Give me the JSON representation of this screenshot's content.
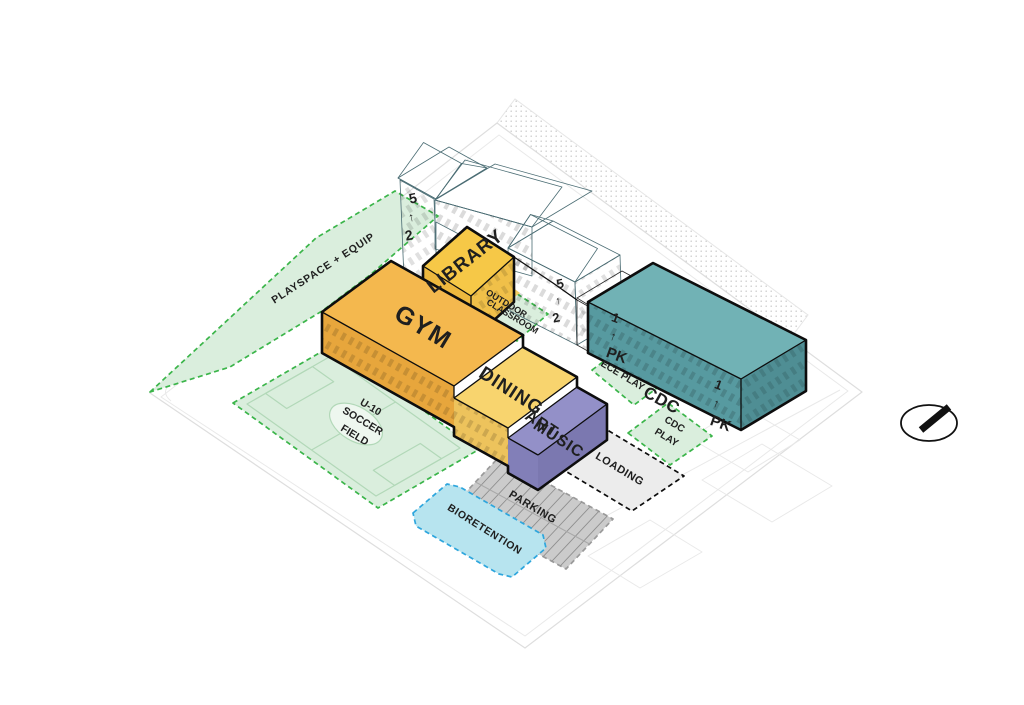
{
  "diagram": {
    "kind": "axonometric campus site plan",
    "compass": "north-arrow"
  },
  "colors": {
    "gym_roof": "#f4b84e",
    "gym_face": "#e7a63c",
    "dining_roof": "#f8d46e",
    "dining_face": "#edc35c",
    "art_roof": "#9390c8",
    "art_face": "#827fb8",
    "art_end": "#7b78b0",
    "library_roof": "#f6c847",
    "library_sw": "#edb83e",
    "library_se": "#f0c049",
    "connector": "#f2cd63",
    "cdc_roof": "#71b2b5",
    "cdc_front": "#579aa0",
    "cdc_side": "#4f8e94",
    "existing_roof": "#c6f0f4",
    "existing_roof_lit": "#d4f4f7",
    "existing_wall": "#aee7ee",
    "existing_wall_dark": "#9bdce5",
    "tan_wall": "#e6dcb2",
    "tan_roof": "#ece4c5",
    "green_fill": "#daeedd",
    "green_border": "#3bb54a",
    "bio_fill": "#b7e4ef",
    "bio_border": "#2ea6dd",
    "parking_fill": "#cbcbcb",
    "parking_border": "#9a9a9a",
    "parking_stripe": "#8f8f8f",
    "loading_fill": "#ececec",
    "outline": "#0d0d0d",
    "label": "#1f1f1f",
    "arrow_white": "#ffffff"
  },
  "areas": {
    "playspace": {
      "label": "PLAYSPACE + EQUIP"
    },
    "soccer": {
      "lines": [
        "U-10",
        "SOCCER",
        "FIELD"
      ]
    },
    "outdoor_classroom": {
      "lines": [
        "OUTDOOR",
        "CLASSROOM"
      ]
    },
    "ece_play": {
      "label": "ECE PLAY"
    },
    "cdc_play": {
      "lines": [
        "CDC",
        "PLAY"
      ]
    },
    "loading": {
      "label": "LOADING"
    },
    "parking": {
      "label": "PARKING"
    },
    "bioretention": {
      "label": "BIORETENTION"
    }
  },
  "buildings": {
    "gym": {
      "label": "GYM"
    },
    "dining": {
      "label": "DINING"
    },
    "art_music": {
      "lines": [
        "ART",
        "MUSIC"
      ]
    },
    "library": {
      "label": "LIBRARY"
    },
    "cdc": {
      "label": "CDC"
    }
  },
  "floor_markers": [
    {
      "id": "existing-west",
      "top": "5",
      "arrow": "↑",
      "bottom": "2"
    },
    {
      "id": "existing-east",
      "top": "5",
      "arrow": "↑",
      "bottom": "2"
    },
    {
      "id": "cdc-west",
      "top": "1",
      "arrow": "↑",
      "bottom": "PK"
    },
    {
      "id": "cdc-east",
      "top": "1",
      "arrow": "↑",
      "bottom": "PK"
    }
  ]
}
